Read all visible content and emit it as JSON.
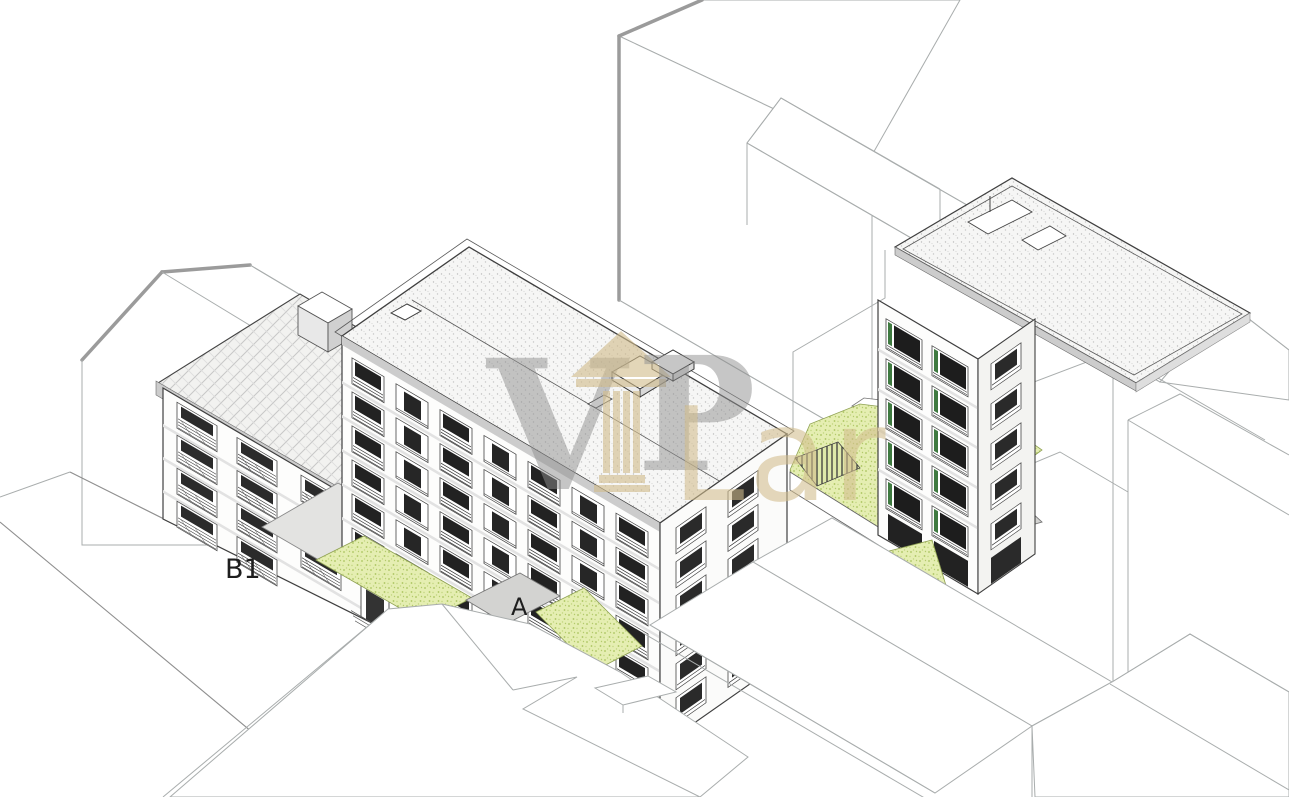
{
  "title": "Axonometric architectural site drawing of residential buildings",
  "labels": {
    "building_b1": "B1",
    "entrance_a": "A"
  },
  "watermark": {
    "letter_v": "V",
    "letter_p": "P",
    "word_lar": "Lar",
    "icon": "classical-column-icon",
    "color_gray": "#9a9a9a",
    "color_tan": "#d2bd8d"
  },
  "palette": {
    "background": "#ffffff",
    "detail_line": "#3f3f3f",
    "context_line": "#a9adad",
    "context_thick_line": "#9b9b9b",
    "parapet_gray": "#cccccc",
    "walkway_gray": "#d3d3d1",
    "driveway_gray": "#e3e3e1",
    "glazing_dark": "#1e1e1e",
    "grass_fill": "#e5eeb2",
    "grass_dot": "#a9c45e",
    "window_accent_green": "#3f7a40",
    "roof_stipple": "#f6f6f5",
    "roof_tile": "#f2f2f0"
  },
  "scene": {
    "buildings": [
      {
        "id": "building-b1",
        "label": "B1",
        "roof": "pitched-tile-hatch",
        "window_rows": 4
      },
      {
        "id": "building-a",
        "label": "A",
        "roof": "flat-stipple",
        "window_rows": 6
      },
      {
        "id": "building-right-tower",
        "label": "",
        "roof": "flat-stipple",
        "window_rows": 5
      }
    ],
    "landscape": [
      "lawn-strip-left",
      "entrance-walkway",
      "lawn-strip-right",
      "courtyard-lawn",
      "ramp-hatched",
      "tower-base-lawn"
    ],
    "context": [
      "gable-house-left",
      "slab-block-top",
      "gable-block-top-right",
      "walls-right",
      "gable-roofs-foreground",
      "flat-slab-foreground"
    ]
  }
}
